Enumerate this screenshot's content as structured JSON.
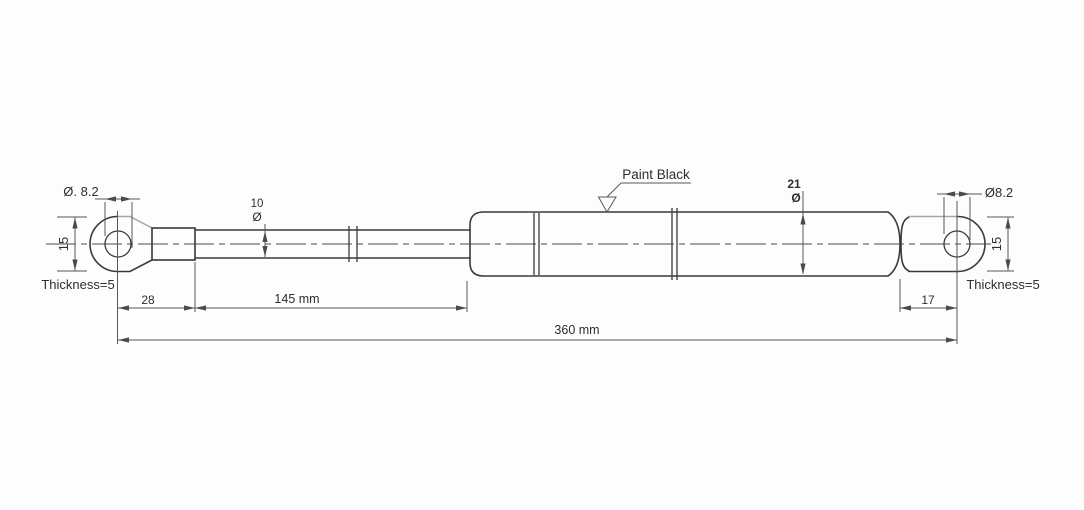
{
  "colors": {
    "outline": "#3a3a3a",
    "dimension_lines": "#585858",
    "faded_line": "#a6a6a6",
    "background": "#fdfdfd"
  },
  "annotations": {
    "paint_note": "Paint Black",
    "left_eyelet": {
      "hole_diameter": "Ø. 8.2",
      "height": "15",
      "thickness": "Thickness=5"
    },
    "right_eyelet": {
      "hole_diameter": "Ø8.2",
      "height": "15",
      "thickness": "Thickness=5"
    },
    "rod": {
      "diameter_value": "10",
      "diameter_symbol": "Ø"
    },
    "cylinder": {
      "diameter_value": "21",
      "diameter_symbol": "Ø"
    },
    "dimensions": {
      "eyelet_to_rod": "28",
      "rod_length": "145 mm",
      "right_eyelet_offset": "17",
      "total_length": "360 mm"
    }
  }
}
